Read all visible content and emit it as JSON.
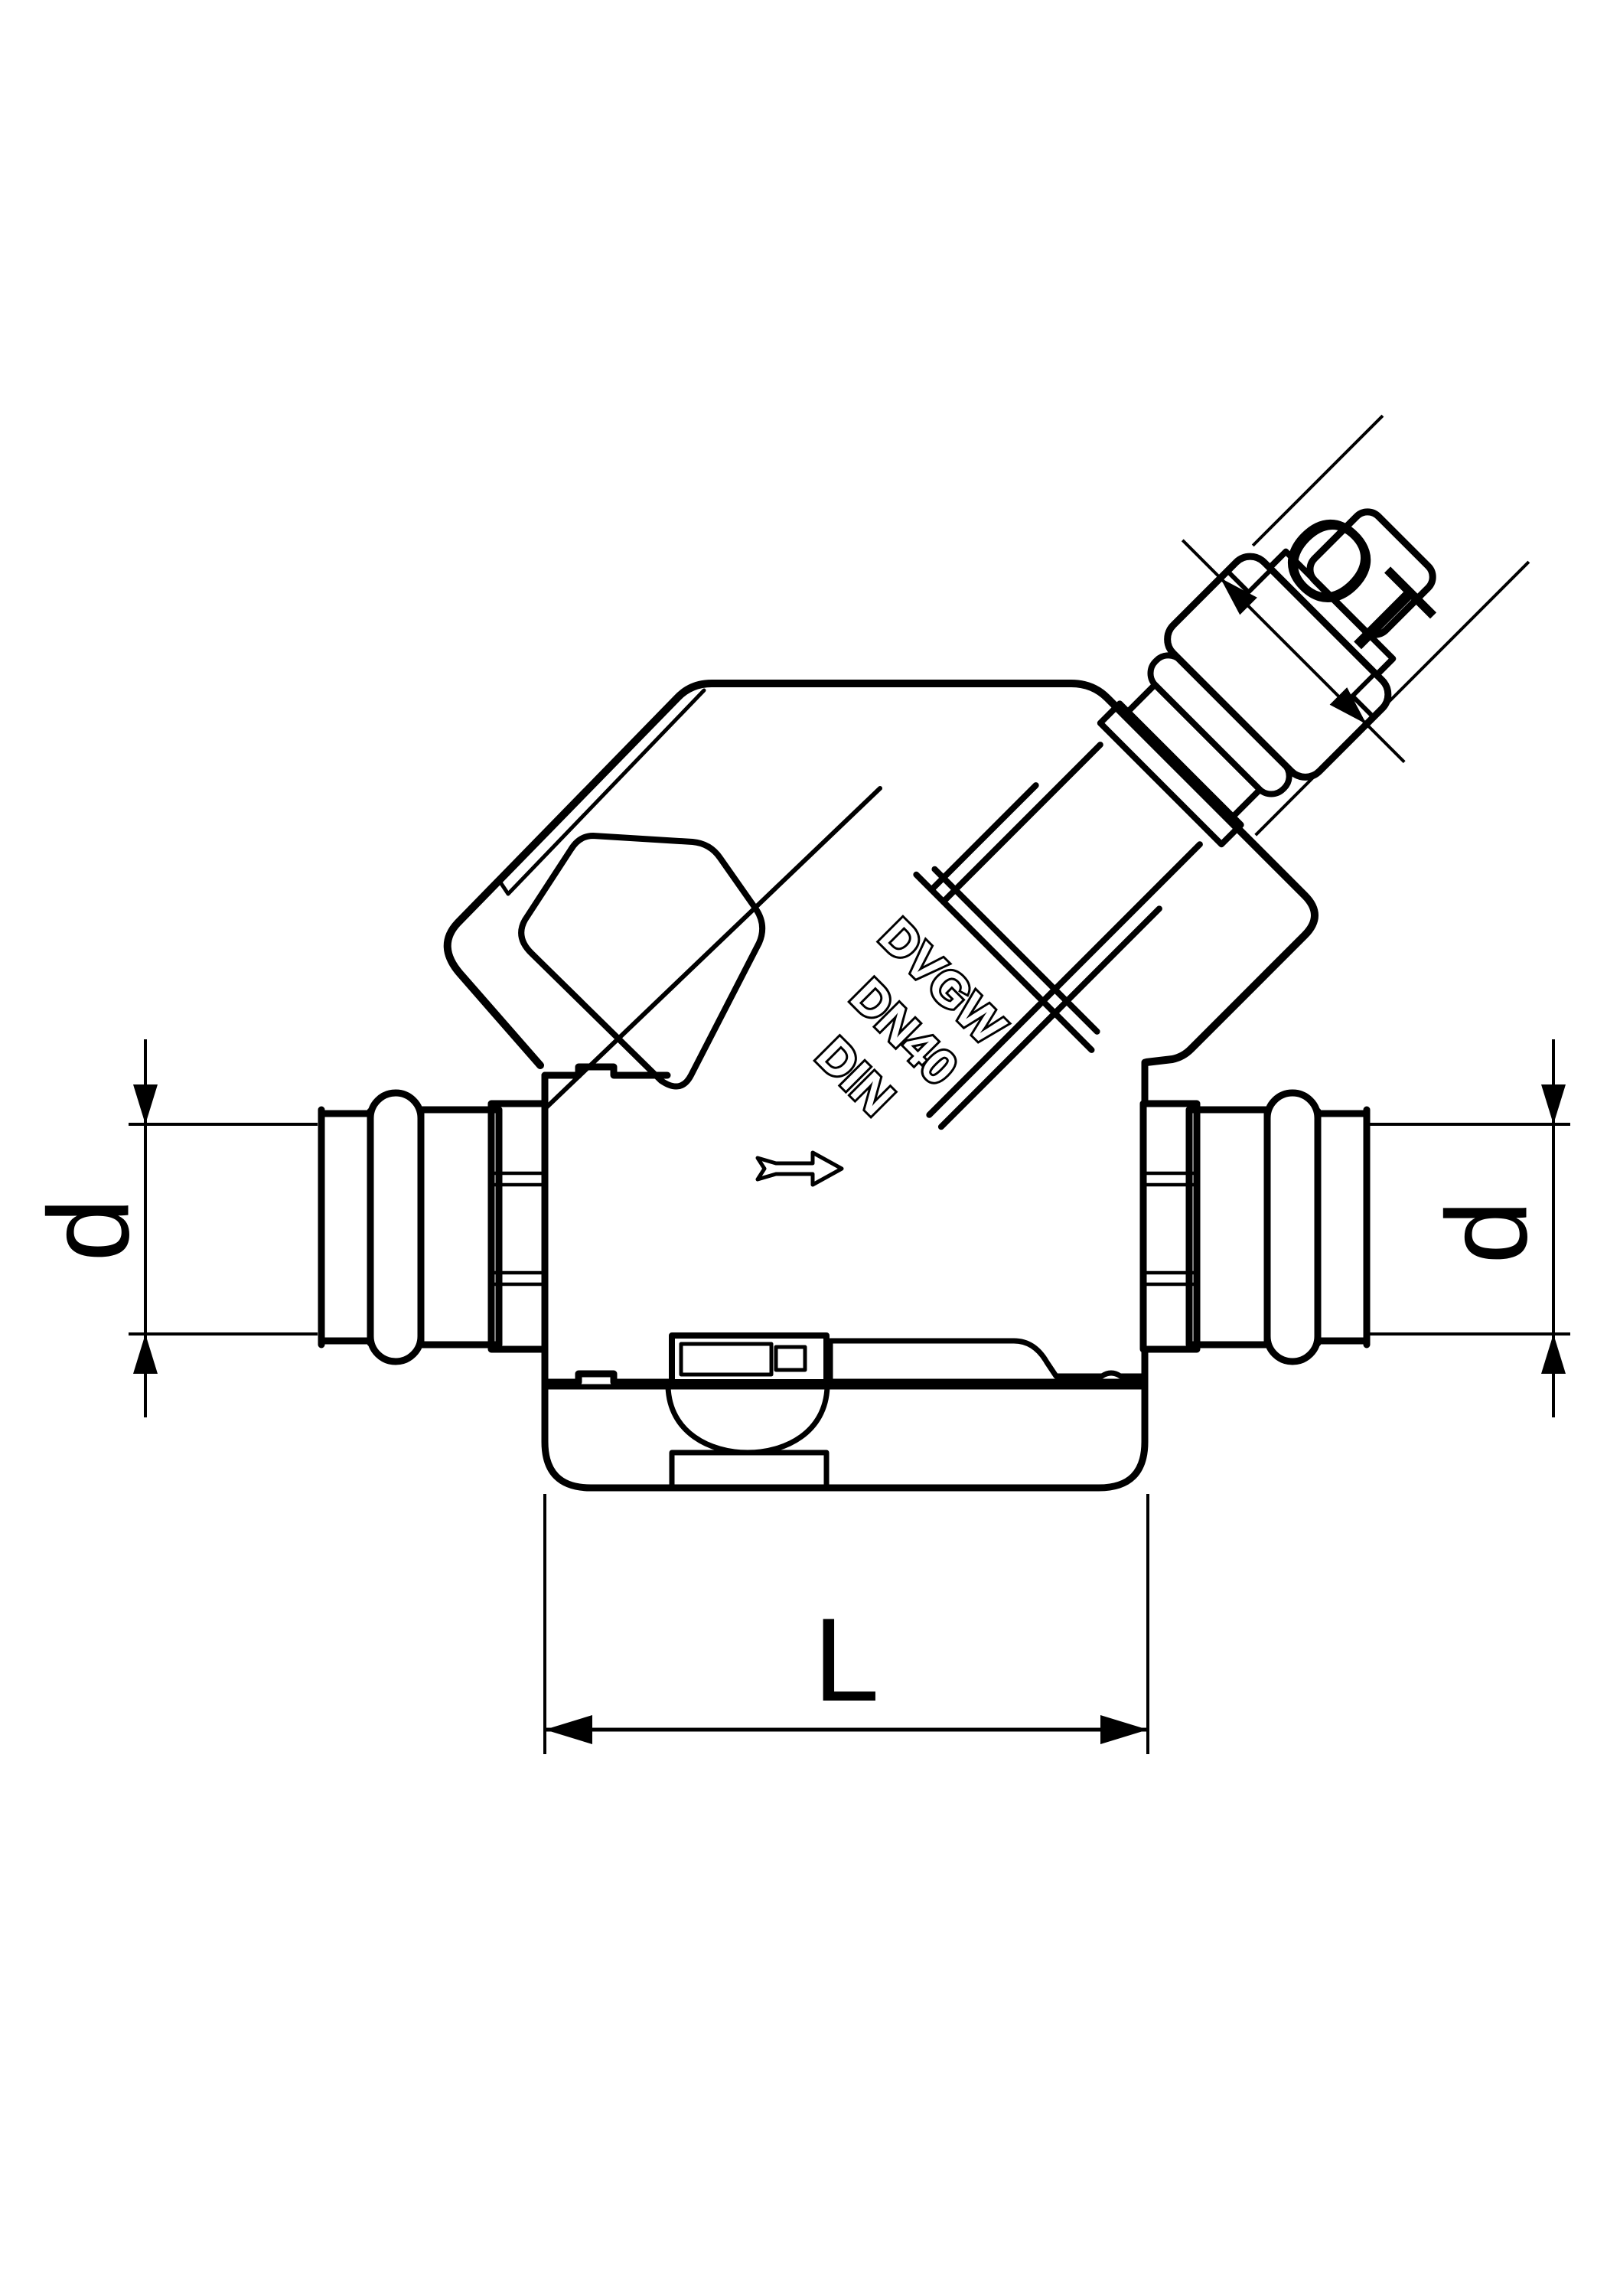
{
  "page": {
    "background_color": "#ffffff",
    "line_color": "#000000",
    "kind": "technical line drawing",
    "subject": "pressfitting check valve, side elevation with dimensioning"
  },
  "dimensions": {
    "ot": {
      "label": "OT",
      "orientation": "diagonal-45deg",
      "location": "upper-right outlet connector"
    },
    "d_left": {
      "label": "d",
      "orientation": "vertical",
      "location": "left pipe end diameter"
    },
    "d_right": {
      "label": "d",
      "orientation": "vertical",
      "location": "right pipe end diameter"
    },
    "length": {
      "label": "L",
      "orientation": "horizontal",
      "location": "overall body length at bottom cap"
    }
  },
  "markings": {
    "line1": "DVGW",
    "line2": "DN40",
    "line3": "DIN",
    "rotation": "45deg along valve bonnet"
  },
  "icons": {
    "flow_arrow": "flow-direction-arrow pointing right"
  }
}
